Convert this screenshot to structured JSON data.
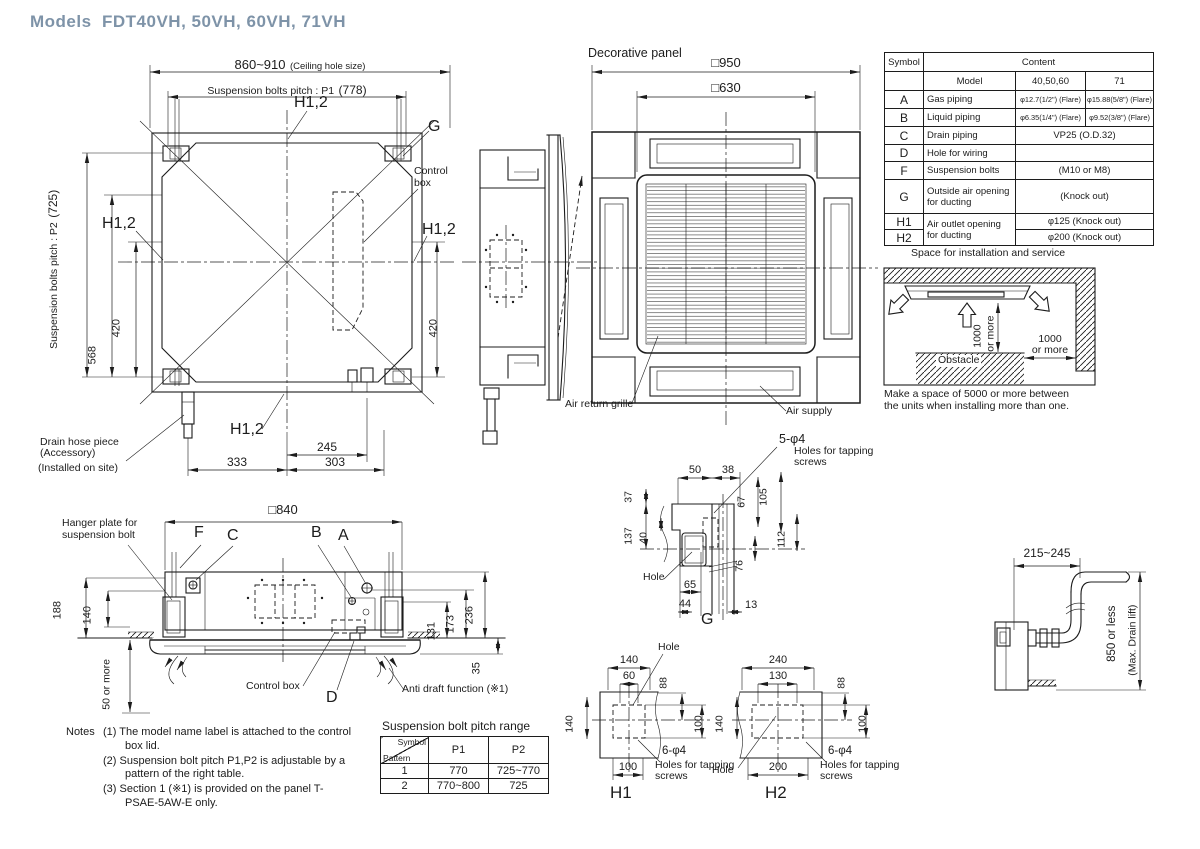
{
  "colors": {
    "line": "#1c1c1c",
    "title": "#7e93a8"
  },
  "title": "Models  FDT40VH, 50VH, 60VH, 71VH",
  "shared": {
    "h12": "H1,2",
    "hole": "Hole",
    "holes5": "5-φ4",
    "holes6": "6-φ4",
    "holes_note": "Holes for tapping screws",
    "d1000": "1000",
    "or_more": "or more"
  },
  "plan": {
    "dim_ceiling": "860~910",
    "ceiling_note": "(Ceiling hole size)",
    "p1_label": "Suspension bolts pitch : P1",
    "p1_value": "(778)",
    "p2_label": "Suspension bolts pitch : P2",
    "p2_value": "(725)",
    "g": "G",
    "control_box": "Control box",
    "d568": "568",
    "d420": "420",
    "d245": "245",
    "d333": "333",
    "d303": "303",
    "drain_l1": "Drain hose piece",
    "drain_l2": "(Accessory)",
    "drain_l3": "(Installed on site)"
  },
  "panel": {
    "title": "Decorative panel",
    "d950": "□950",
    "d630": "□630",
    "air_return": "Air return grille",
    "air_supply": "Air supply"
  },
  "spec_table": {
    "h_symbol": "Symbol",
    "h_content": "Content",
    "h_model": "Model",
    "h_models_a": "40,50,60",
    "h_models_b": "71",
    "air_outlet_label": "Air outlet opening for ducting",
    "rows": [
      {
        "sym": "A",
        "label": "Gas piping",
        "v1": "φ12.7(1/2\") (Flare)",
        "v2": "φ15.88(5/8\") (Flare)"
      },
      {
        "sym": "B",
        "label": "Liquid piping",
        "v1": "φ6.35(1/4\") (Flare)",
        "v2": "φ9.52(3/8\") (Flare)"
      },
      {
        "sym": "C",
        "label": "Drain piping",
        "span": "VP25 (O.D.32)"
      },
      {
        "sym": "D",
        "label": "Hole for wiring",
        "span": ""
      },
      {
        "sym": "F",
        "label": "Suspension bolts",
        "span": "(M10 or M8)"
      },
      {
        "sym": "G",
        "label": "Outside air opening for ducting",
        "span": "(Knock out)"
      },
      {
        "sym": "H1",
        "v": "φ125 (Knock out)"
      },
      {
        "sym": "H2",
        "v": "φ200 (Knock out)"
      }
    ]
  },
  "install": {
    "title": "Space for installation and service",
    "obstacle": "Obstacle",
    "caption": "Make a space of 5000 or more between the units when installing more than one."
  },
  "g_detail": {
    "label": "G",
    "d50": "50",
    "d38": "38",
    "d37": "37",
    "d137": "137",
    "d40": "40",
    "d67": "67",
    "d105": "105",
    "d112": "112",
    "d76": "76",
    "d65": "65",
    "d44": "44",
    "d13": "13"
  },
  "h1_detail": {
    "label": "H1",
    "top": "140",
    "inner": "60",
    "d88": "88",
    "left": "140",
    "right": "100",
    "bottom": "100"
  },
  "h2_detail": {
    "label": "H2",
    "top": "240",
    "inner": "130",
    "d88": "88",
    "left": "140",
    "right": "100",
    "bottom": "200"
  },
  "section": {
    "d840": "□840",
    "f": "F",
    "c": "C",
    "b": "B",
    "a": "A",
    "d": "D",
    "hanger_plate": "Hanger plate for suspension bolt",
    "d188": "188",
    "d140": "140",
    "d50_more": "50 or more",
    "d131": "131",
    "d173": "173",
    "d236": "236",
    "d35": "35",
    "control_box": "Control box",
    "anti_draft": "Anti draft function (※1)"
  },
  "notes": {
    "heading": "Notes",
    "items": [
      "(1) The model name label is attached to the control box lid.",
      "(2) Suspension bolt pitch P1,P2 is adjustable by a pattern of the right table.",
      "(3) Section 1 (※1) is provided on the panel T-PSAE-5AW-E only."
    ]
  },
  "pitch_table": {
    "title": "Suspension bolt pitch range",
    "h_symbol": "Symbol",
    "h_pattern": "Pattern",
    "h_p1": "P1",
    "h_p2": "P2",
    "rows": [
      {
        "pattern": "1",
        "p1": "770",
        "p2": "725~770"
      },
      {
        "pattern": "2",
        "p1": "770~800",
        "p2": "725"
      }
    ]
  },
  "drain": {
    "d215": "215~245",
    "d850": "850 or less",
    "max_lift": "(Max. Drain lift)"
  }
}
